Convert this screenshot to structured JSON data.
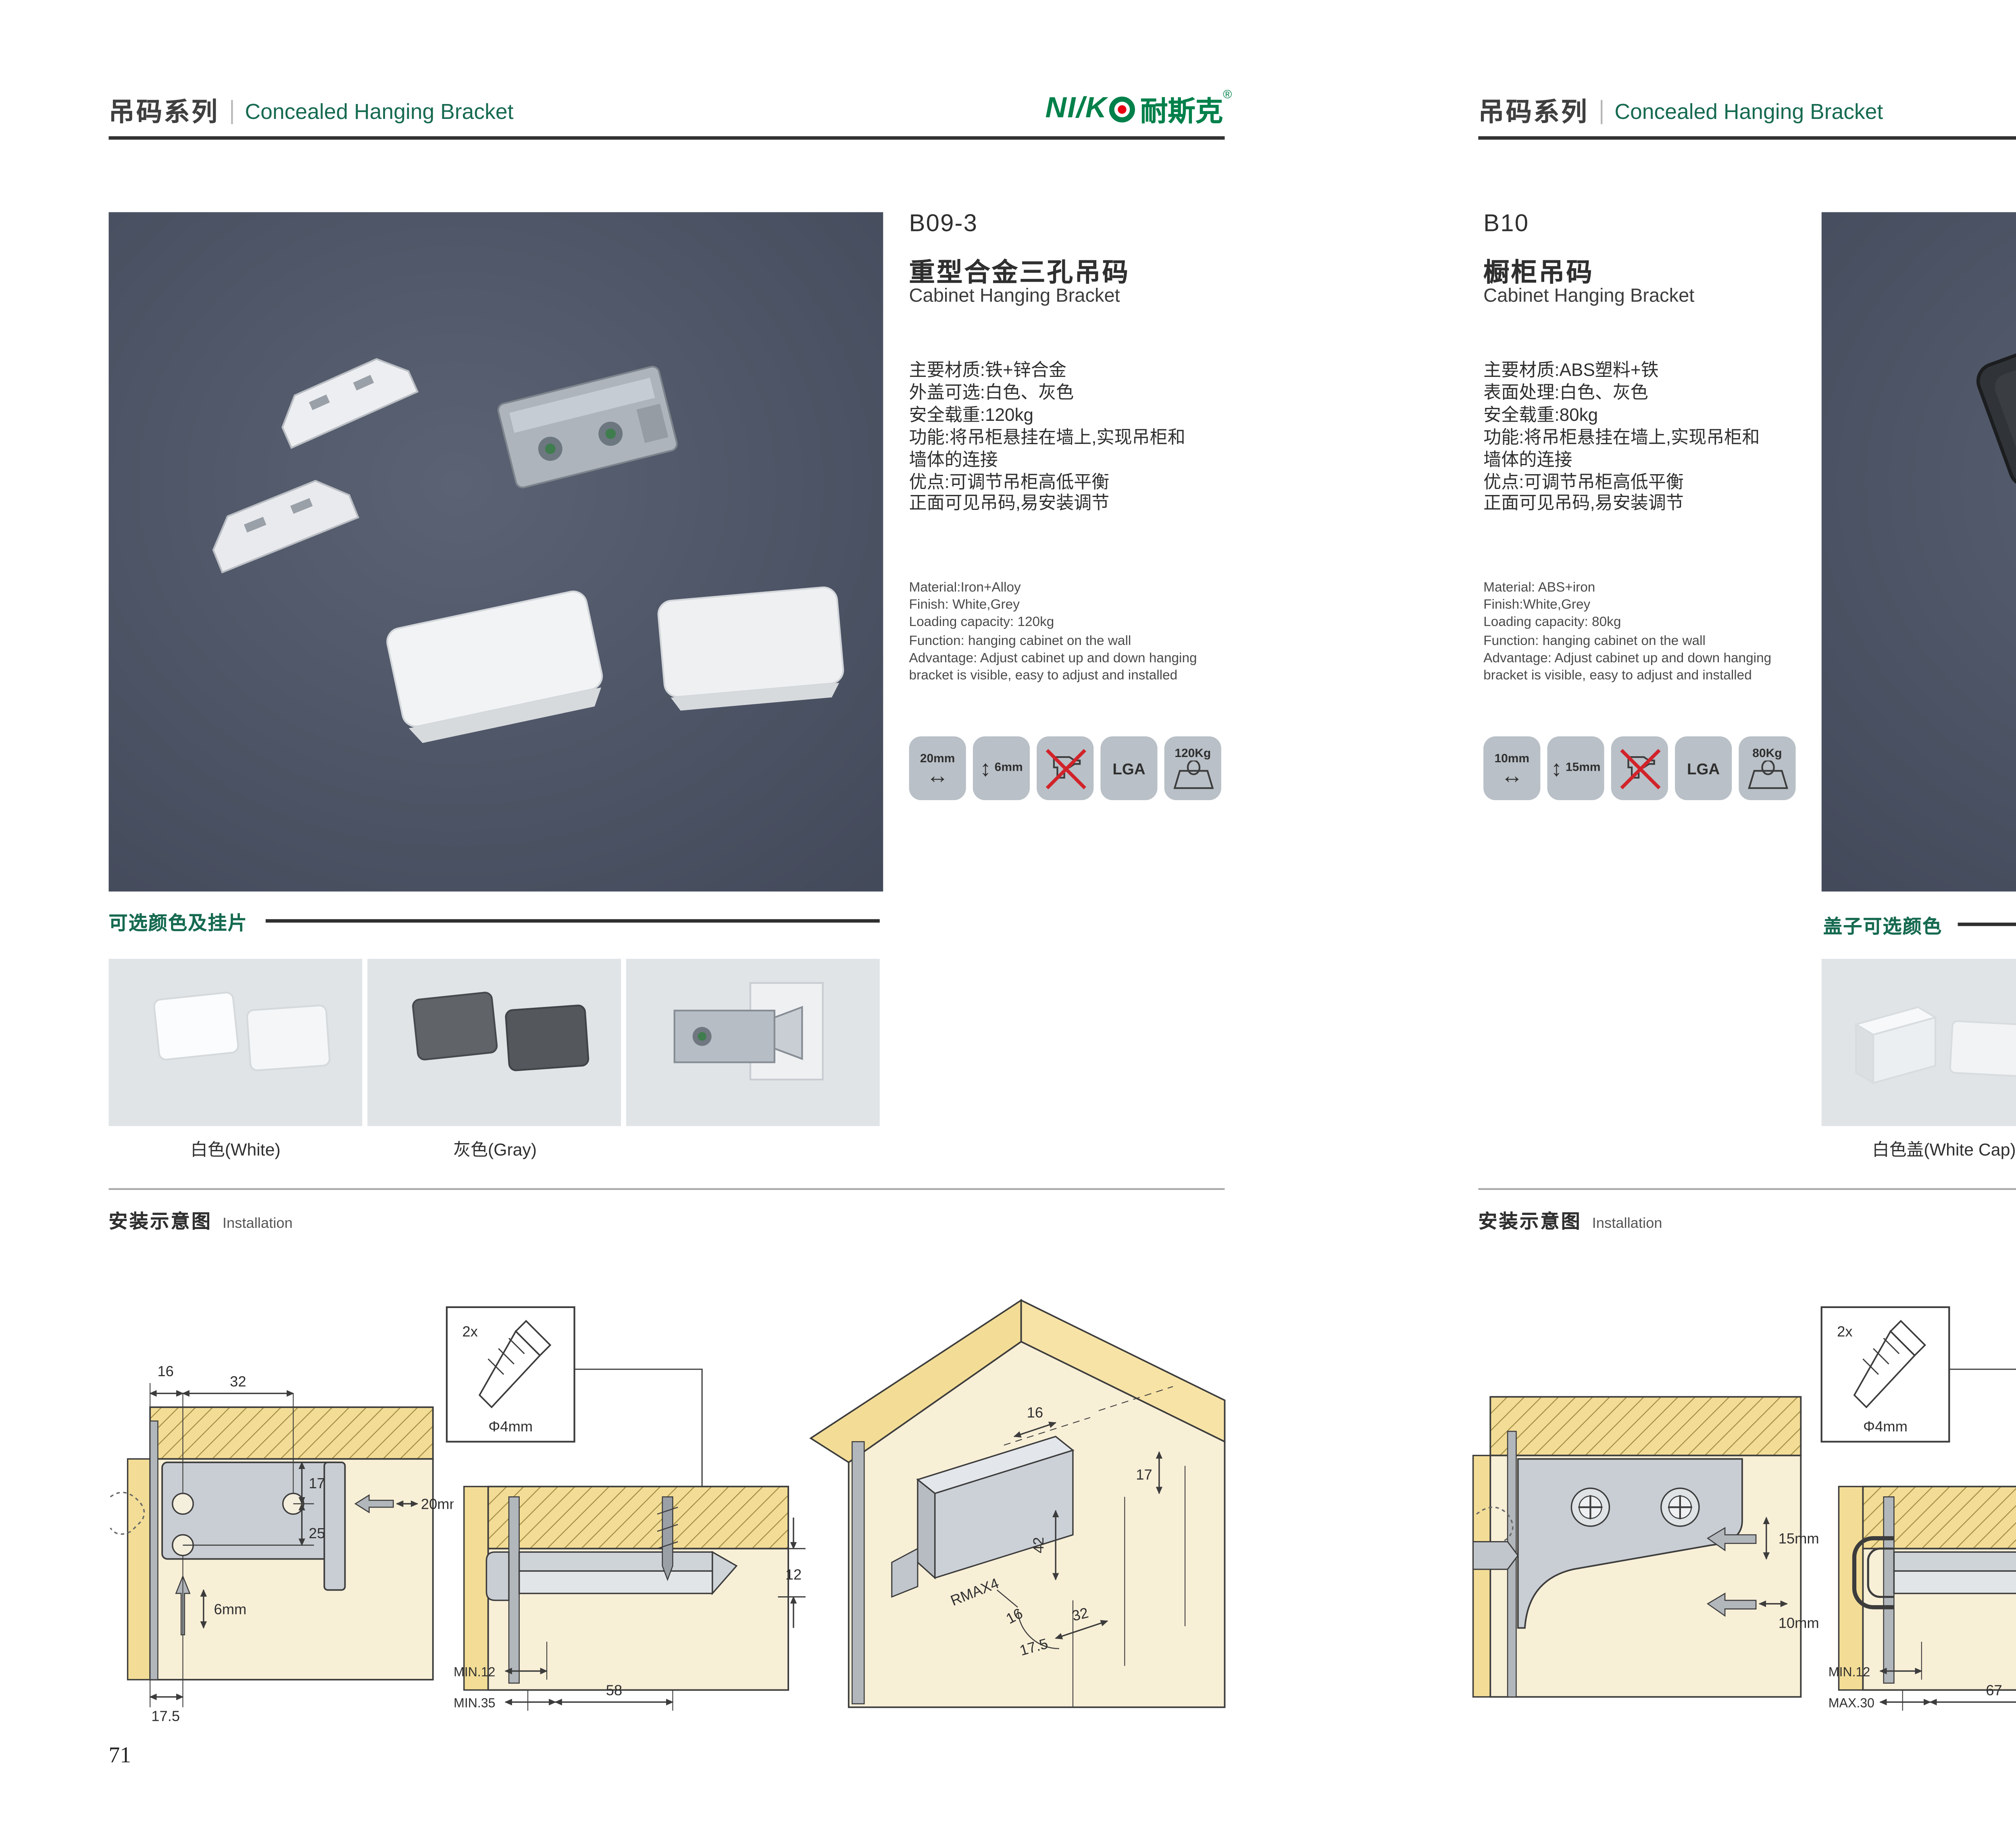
{
  "brand": {
    "logo_latin": "NI/K",
    "logo_cjk": "耐斯克",
    "registered": "®"
  },
  "icons": {
    "arrow_horizontal": "↔",
    "arrow_vertical": "↕"
  },
  "colors": {
    "accent_green": "#166a50",
    "logo_green": "#00804a",
    "logo_red": "#e60012",
    "photo_background": "#4b5364",
    "badge_background": "#b9c0c7",
    "diagram_yellow": "#f3dd96",
    "diagram_cream": "#f8efd7"
  },
  "page_left": {
    "page_number": "71",
    "header": {
      "series_cjk": "吊码系列",
      "series_en": "Concealed Hanging Bracket"
    },
    "product": {
      "code": "B09-3",
      "name_cjk": "重型合金三孔吊码",
      "name_en": "Cabinet Hanging Bracket",
      "specs_cjk": [
        "主要材质:铁+锌合金",
        "外盖可选:白色、灰色",
        "安全载重:120kg",
        "功能:将吊柜悬挂在墙上,实现吊柜和",
        "墙体的连接",
        "优点:可调节吊柜高低平衡",
        "正面可见吊码,易安装调节"
      ],
      "specs_en": [
        "Material:Iron+Alloy",
        "Finish: White,Grey",
        "Loading capacity: 120kg",
        "Function: hanging cabinet on the wall",
        "Advantage: Adjust cabinet up and down hanging",
        "bracket is visible, easy to adjust and installed"
      ],
      "badges": [
        {
          "label": "20mm"
        },
        {
          "label": "6mm"
        },
        {
          "label": ""
        },
        {
          "label": "LGA"
        },
        {
          "label": "120Kg"
        }
      ]
    },
    "colors_section": {
      "title": "可选颜色及挂片",
      "captions": [
        "白色(White)",
        "灰色(Gray)"
      ]
    },
    "install_section": {
      "title_cjk": "安装示意图",
      "title_en": "Installation"
    },
    "diagrams": {
      "d1": {
        "dim_16": "16",
        "dim_32": "32",
        "dim_17": "17",
        "dim_25": "25",
        "dim_20mm": "20mm",
        "dim_6mm": "6mm",
        "dim_17_5": "17.5"
      },
      "d2": {
        "screw_qty": "2x",
        "screw_dia": "Φ4mm",
        "dim_12": "12",
        "dim_min12": "MIN.12",
        "dim_min35": "MIN.35",
        "dim_58": "58"
      },
      "d3": {
        "dim_16_top": "16",
        "dim_17": "17",
        "dim_42": "42",
        "dim_rmax": "RMAX4",
        "dim_16_b": "16",
        "dim_32": "32",
        "dim_17_5": "17.5"
      }
    }
  },
  "page_right": {
    "page_number": "72",
    "header": {
      "series_cjk": "吊码系列",
      "series_en": "Concealed Hanging Bracket"
    },
    "product": {
      "code": "B10",
      "name_cjk": "橱柜吊码",
      "name_en": "Cabinet Hanging Bracket",
      "specs_cjk": [
        "主要材质:ABS塑料+铁",
        "表面处理:白色、灰色",
        "安全载重:80kg",
        "功能:将吊柜悬挂在墙上,实现吊柜和",
        "墙体的连接",
        "优点:可调节吊柜高低平衡",
        "正面可见吊码,易安装调节"
      ],
      "specs_en": [
        "Material: ABS+iron",
        "Finish:White,Grey",
        "Loading capacity: 80kg",
        "Function: hanging cabinet on the wall",
        "Advantage: Adjust cabinet up and down hanging",
        "bracket is visible, easy to adjust and installed"
      ],
      "badges": [
        {
          "label": "10mm"
        },
        {
          "label": "15mm"
        },
        {
          "label": ""
        },
        {
          "label": "LGA"
        },
        {
          "label": "80Kg"
        }
      ]
    },
    "colors_section": {
      "title": "盖子可选颜色",
      "captions": [
        "白色盖(White Cap)",
        "灰色盖(Gray Cap)"
      ]
    },
    "install_section": {
      "title_cjk": "安装示意图",
      "title_en": "Installation"
    },
    "diagrams": {
      "d1": {
        "dim_15mm": "15mm",
        "dim_10mm": "10mm"
      },
      "d2": {
        "screw_qty": "2x",
        "screw_dia": "Φ4mm",
        "dim_18": "18",
        "dim_min12": "MIN.12",
        "dim_max30": "MAX.30",
        "dim_67": "67"
      },
      "d3": {
        "dim_13": "13",
        "dim_42": "42",
        "dim_rmax": "RMAX4",
        "dim_19": "19",
        "dim_32": "32",
        "dim_17": "17"
      }
    }
  }
}
